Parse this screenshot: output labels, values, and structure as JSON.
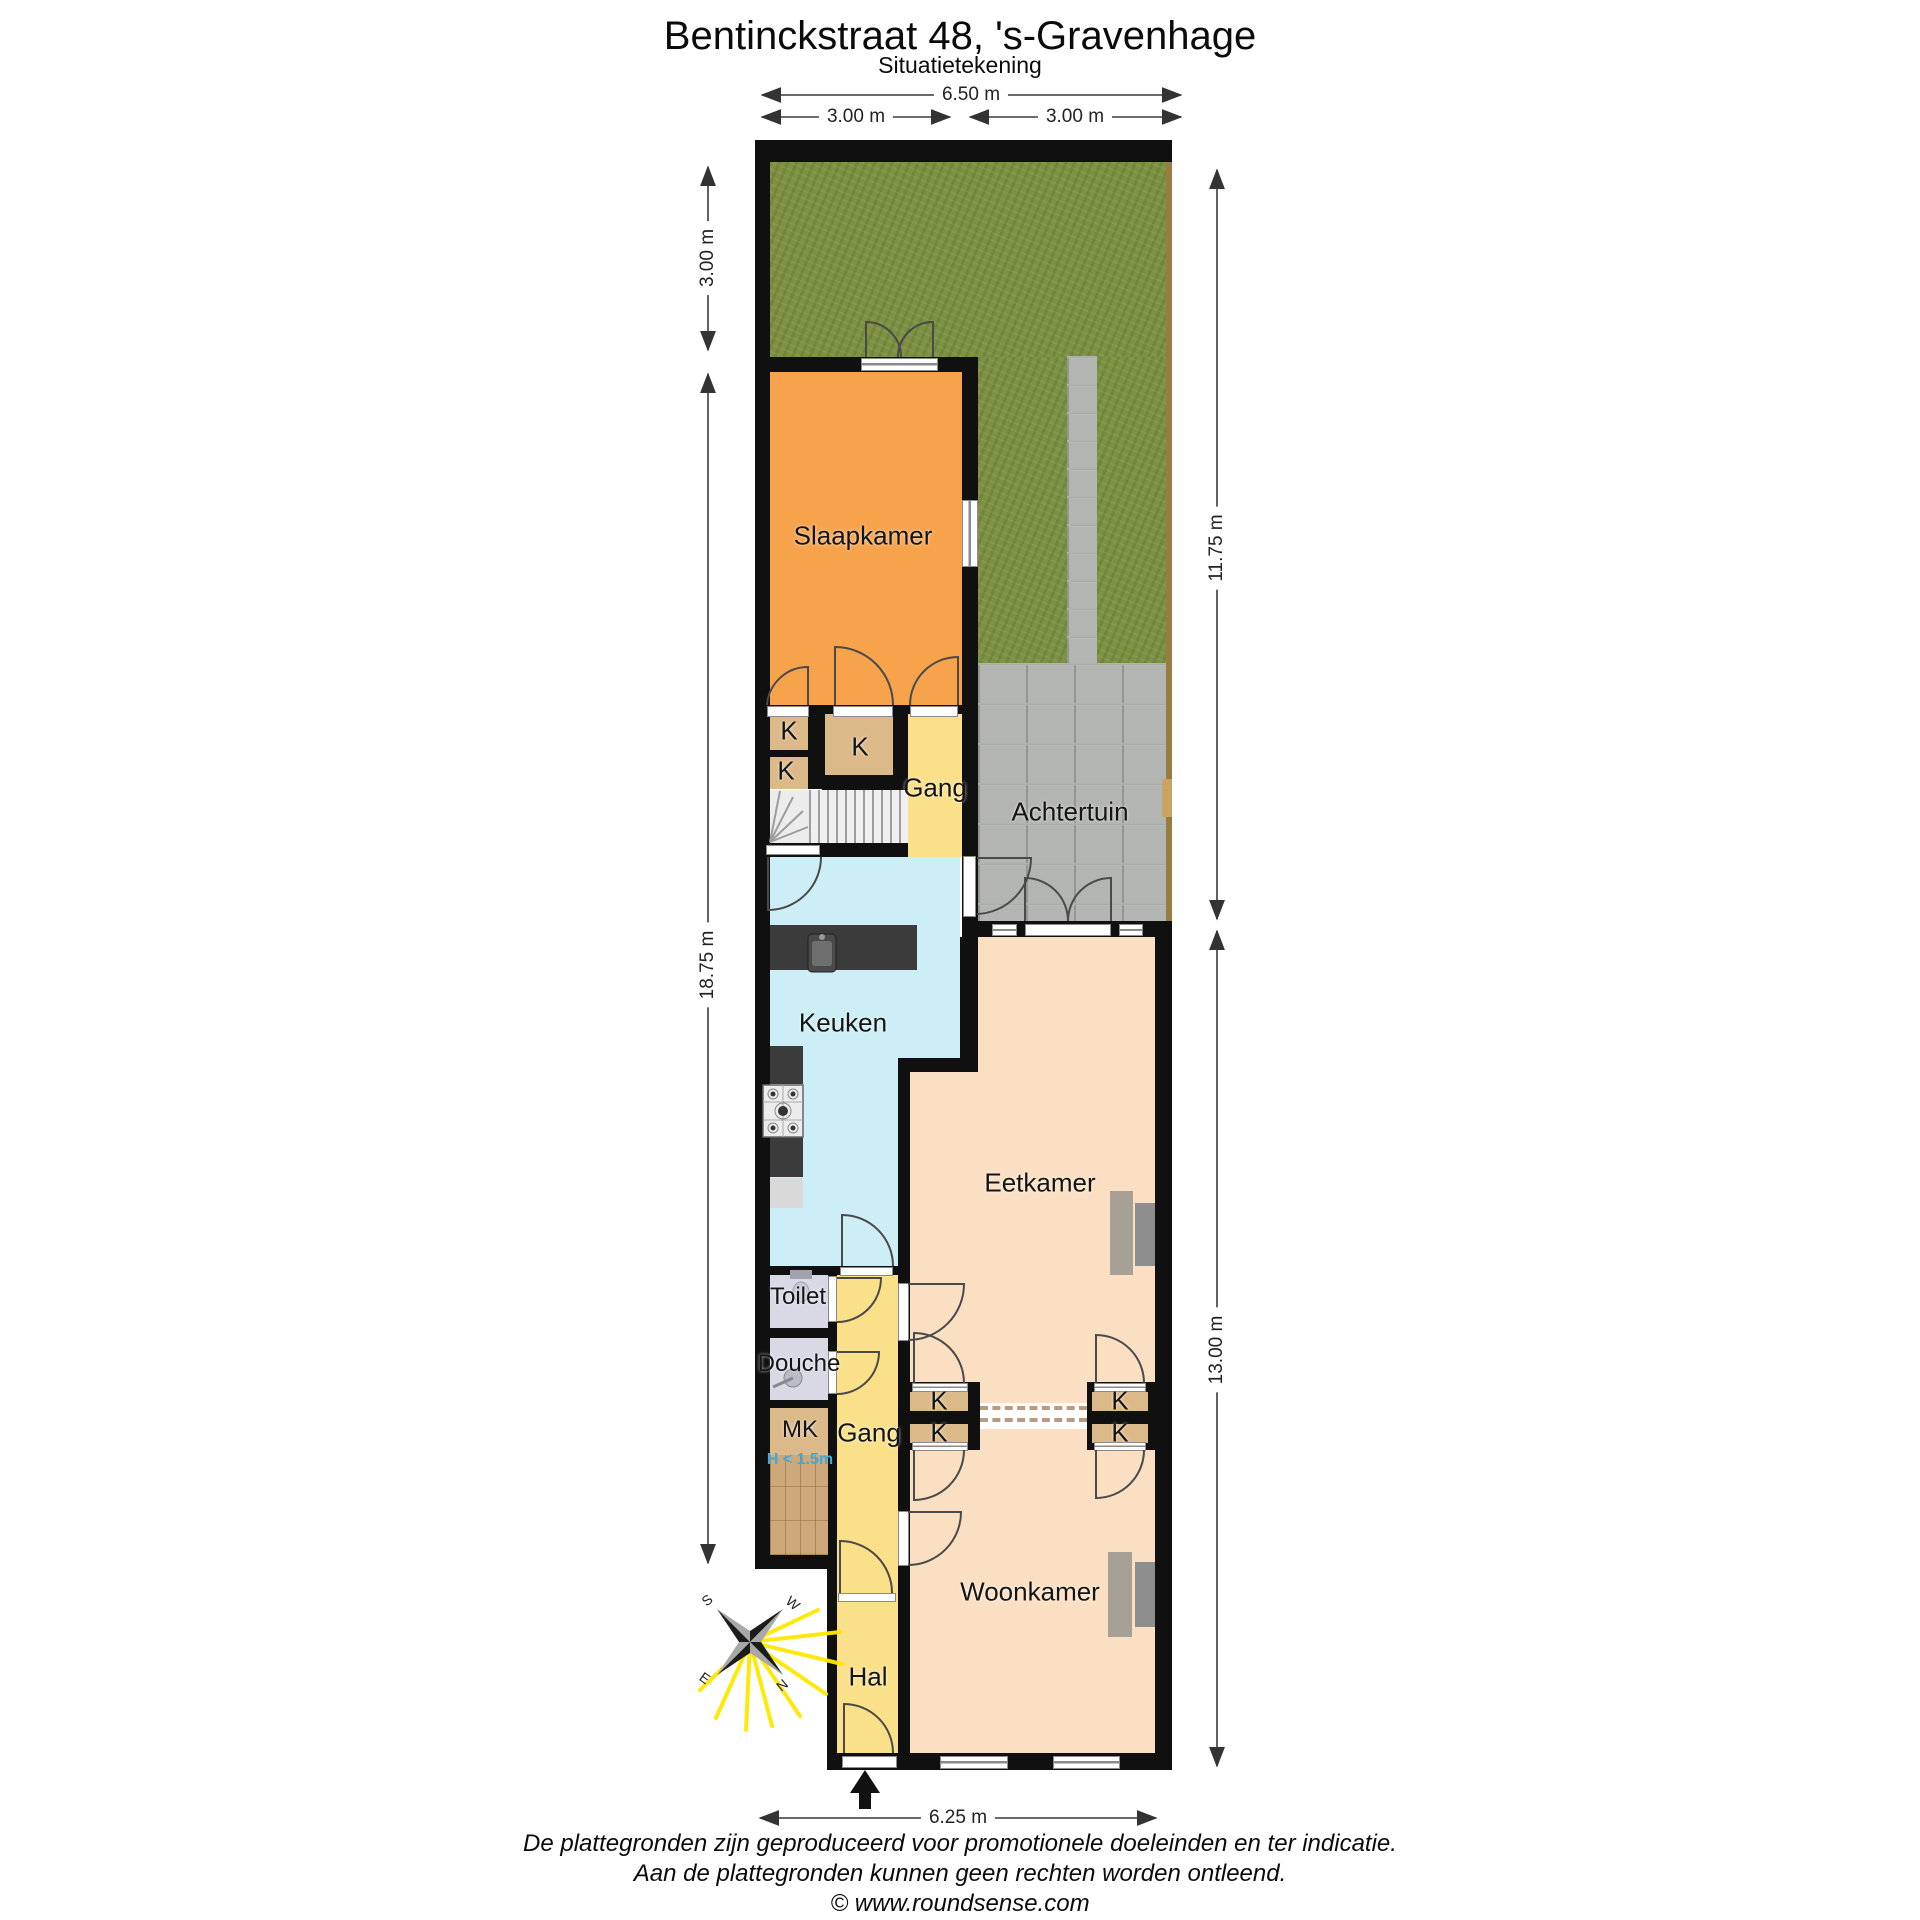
{
  "title": "Bentinckstraat 48, 's-Gravenhage",
  "subtitle": "Situatietekening",
  "dimensions": {
    "top_total": "6.50 m",
    "top_left": "3.00 m",
    "top_right": "3.00 m",
    "left_garden": "3.00 m",
    "left_house": "18.75 m",
    "right_garden": "11.75 m",
    "right_house": "13.00 m",
    "bottom": "6.25 m"
  },
  "rooms": {
    "slaapkamer": "Slaapkamer",
    "achtertuin": "Achtertuin",
    "gang": "Gang",
    "keuken": "Keuken",
    "eetkamer": "Eetkamer",
    "toilet": "Toilet",
    "douche": "Douche",
    "meterkast": "MK",
    "woonkamer": "Woonkamer",
    "hal": "Hal",
    "closet": "K",
    "height_note": "H < 1.5m"
  },
  "compass": {
    "north": "N",
    "east": "E",
    "south": "S",
    "west": "W"
  },
  "footer": {
    "line1": "De plattegronden zijn geproduceerd voor promotionele doeleinden en ter indicatie.",
    "line2": "Aan de plattegronden kunnen geen rechten worden ontleend.",
    "line3": "© www.roundsense.com"
  },
  "colors": {
    "bedroom": "#f6a34c",
    "hallway": "#fae189",
    "closet": "#dcb988",
    "kitchen": "#cdeef6",
    "living": "#fbdfc3",
    "sanitary": "#d9d9e6",
    "grass": "#7d9143",
    "paving": "#b3b5b2",
    "wall": "#101010",
    "height_note_text": "#3fa9dc"
  }
}
